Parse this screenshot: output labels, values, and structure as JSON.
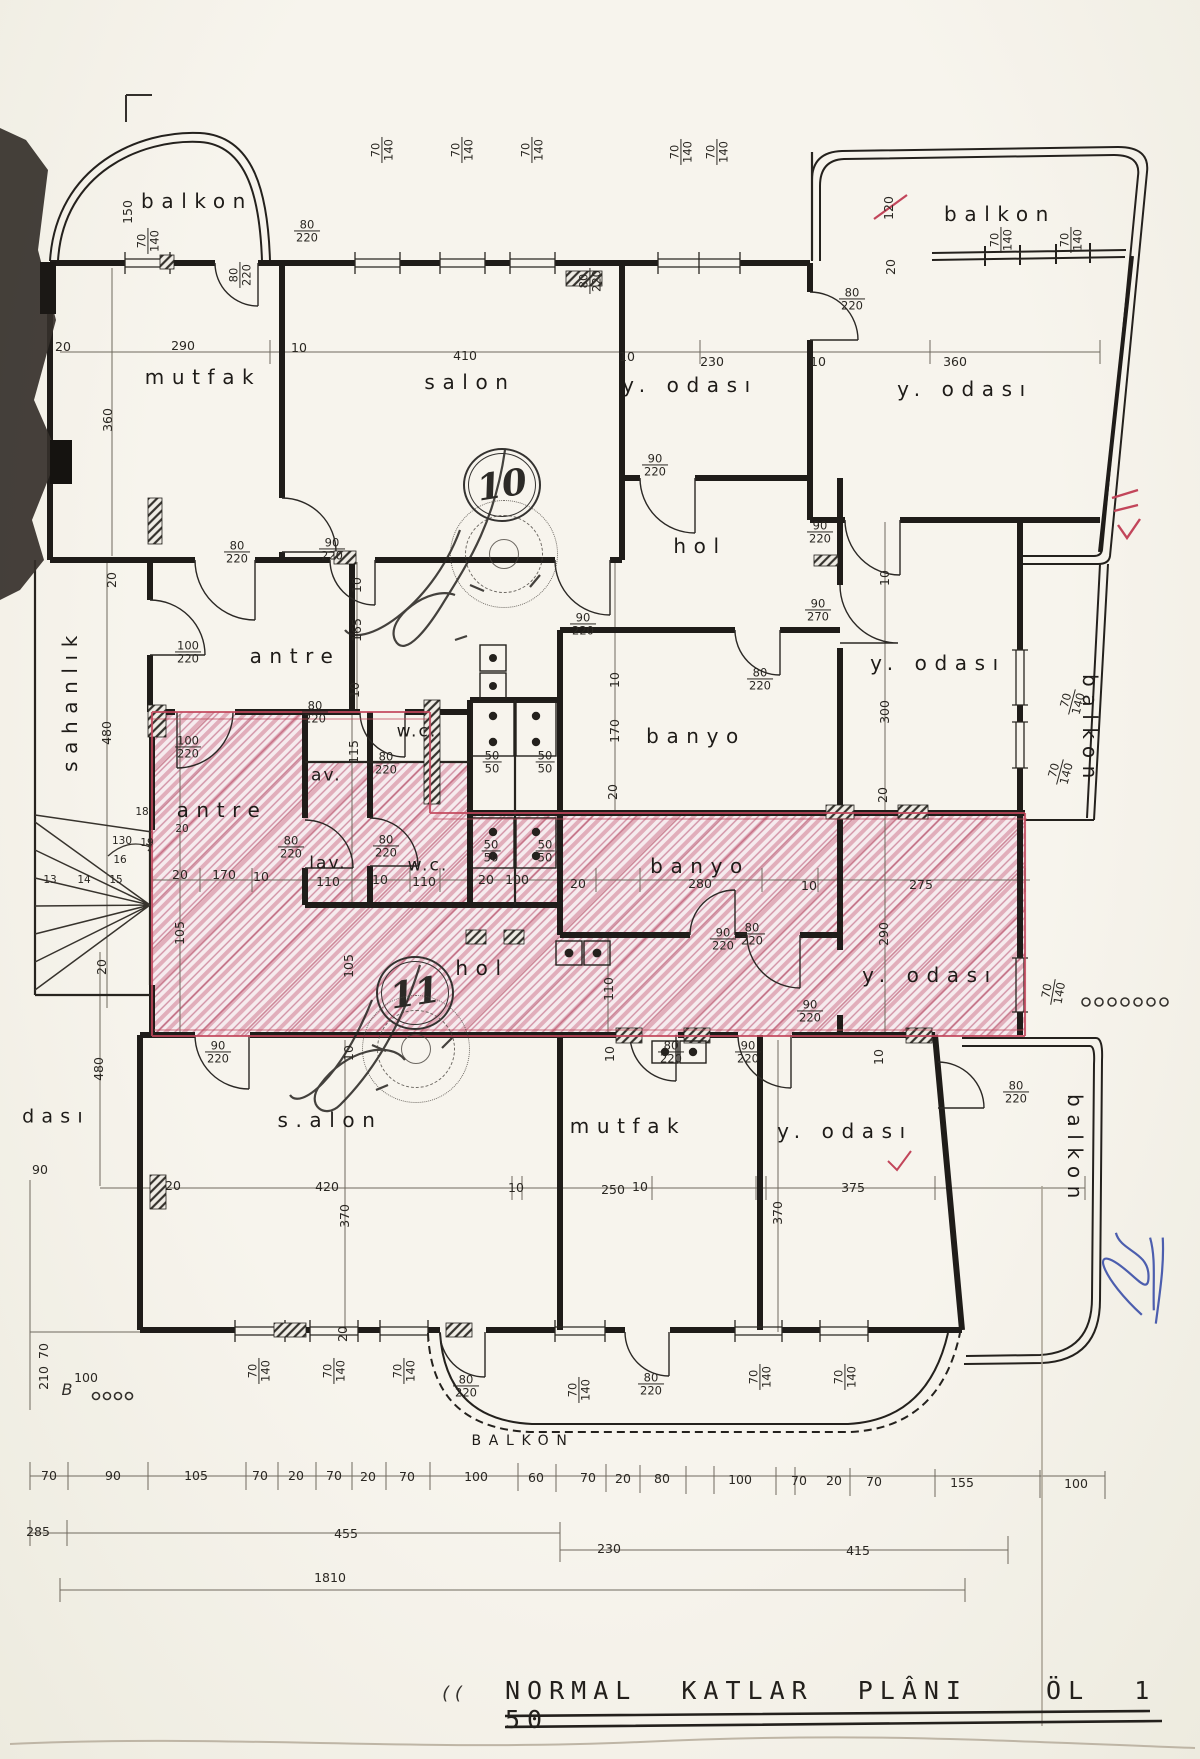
{
  "title_block": {
    "title": "NORMAL KATLAR PLÂNI",
    "scale_note": "ÖL 1 50"
  },
  "stamps": {
    "upper_number": "10",
    "lower_number": "11"
  },
  "plan_labels": {
    "rooms": [
      {
        "t": "balkon",
        "x": 197,
        "y": 201
      },
      {
        "t": "mutfak",
        "x": 203,
        "y": 377
      },
      {
        "t": "salon",
        "x": 470,
        "y": 382
      },
      {
        "t": "y. odası",
        "x": 690,
        "y": 385
      },
      {
        "t": "balkon",
        "x": 1000,
        "y": 214
      },
      {
        "t": "y. odası",
        "x": 965,
        "y": 389
      },
      {
        "t": "hol",
        "x": 700,
        "y": 546
      },
      {
        "t": "antre",
        "x": 295,
        "y": 656
      },
      {
        "t": "w.c.",
        "x": 417,
        "y": 732,
        "fs": 17,
        "ls": ".12em"
      },
      {
        "t": "lav.",
        "x": 323,
        "y": 776,
        "fs": 17,
        "ls": ".12em"
      },
      {
        "t": "banyo",
        "x": 696,
        "y": 736
      },
      {
        "t": "y. odası",
        "x": 938,
        "y": 663
      },
      {
        "t": "balkon",
        "x": 1090,
        "y": 730,
        "r": 90
      },
      {
        "t": "sahanlık",
        "x": 70,
        "y": 700,
        "r": -90
      },
      {
        "t": "antre",
        "x": 222,
        "y": 810
      },
      {
        "t": "lav.",
        "x": 328,
        "y": 864,
        "fs": 17,
        "ls": ".12em"
      },
      {
        "t": "w.c.",
        "x": 428,
        "y": 866,
        "fs": 17,
        "ls": ".12em"
      },
      {
        "t": "banyo",
        "x": 700,
        "y": 866
      },
      {
        "t": "hol",
        "x": 482,
        "y": 968
      },
      {
        "t": "y. odası",
        "x": 930,
        "y": 975
      },
      {
        "t": "s.alon",
        "x": 330,
        "y": 1120
      },
      {
        "t": "mutfak",
        "x": 628,
        "y": 1126
      },
      {
        "t": "y. odası",
        "x": 845,
        "y": 1131
      },
      {
        "t": "balkon",
        "x": 1075,
        "y": 1150,
        "r": 90
      },
      {
        "t": "dası",
        "x": 56,
        "y": 1117,
        "fs": 19
      },
      {
        "t": "BALKON",
        "x": 523,
        "y": 1441,
        "fs": 14,
        "ls": ".55em"
      }
    ],
    "dims": [
      {
        "t": "150",
        "x": 128,
        "y": 212,
        "r": -90
      },
      {
        "t": "70/140",
        "x": 148,
        "y": 241,
        "r": -90
      },
      {
        "t": "80/220",
        "x": 307,
        "y": 231
      },
      {
        "t": "80/220",
        "x": 240,
        "y": 275,
        "r": -90
      },
      {
        "t": "290",
        "x": 183,
        "y": 346
      },
      {
        "t": "20",
        "x": 63,
        "y": 347
      },
      {
        "t": "10",
        "x": 299,
        "y": 348
      },
      {
        "t": "360",
        "x": 108,
        "y": 420,
        "r": -90
      },
      {
        "t": "70/140",
        "x": 382,
        "y": 150,
        "r": -90
      },
      {
        "t": "70/140",
        "x": 462,
        "y": 150,
        "r": -90
      },
      {
        "t": "70/140",
        "x": 532,
        "y": 150,
        "r": -90
      },
      {
        "t": "70/140",
        "x": 681,
        "y": 152,
        "r": -90
      },
      {
        "t": "70/140",
        "x": 717,
        "y": 152,
        "r": -90
      },
      {
        "t": "80/220",
        "x": 590,
        "y": 281,
        "r": -90
      },
      {
        "t": "410",
        "x": 465,
        "y": 356
      },
      {
        "t": "10",
        "x": 627,
        "y": 357
      },
      {
        "t": "230",
        "x": 712,
        "y": 362
      },
      {
        "t": "120",
        "x": 889,
        "y": 208,
        "r": -90
      },
      {
        "t": "20",
        "x": 891,
        "y": 267,
        "r": -90
      },
      {
        "t": "80/220",
        "x": 852,
        "y": 299
      },
      {
        "t": "70/140",
        "x": 1001,
        "y": 240,
        "r": -90
      },
      {
        "t": "70/140",
        "x": 1071,
        "y": 240,
        "r": -90
      },
      {
        "t": "360",
        "x": 955,
        "y": 362
      },
      {
        "t": "10",
        "x": 818,
        "y": 362
      },
      {
        "t": "90/220",
        "x": 655,
        "y": 465
      },
      {
        "t": "90/220",
        "x": 820,
        "y": 532
      },
      {
        "t": "90/220",
        "x": 583,
        "y": 624
      },
      {
        "t": "90/270",
        "x": 818,
        "y": 610
      },
      {
        "t": "80/220",
        "x": 760,
        "y": 679
      },
      {
        "t": "170",
        "x": 615,
        "y": 731,
        "r": -90
      },
      {
        "t": "10",
        "x": 615,
        "y": 680,
        "r": -90
      },
      {
        "t": "20",
        "x": 613,
        "y": 792,
        "r": -90
      },
      {
        "t": "50/50",
        "x": 492,
        "y": 762
      },
      {
        "t": "50/50",
        "x": 545,
        "y": 762
      },
      {
        "t": "100/220",
        "x": 188,
        "y": 652
      },
      {
        "t": "80/220",
        "x": 237,
        "y": 552
      },
      {
        "t": "90/220",
        "x": 332,
        "y": 549
      },
      {
        "t": "165",
        "x": 357,
        "y": 630,
        "r": -90
      },
      {
        "t": "10",
        "x": 357,
        "y": 585,
        "r": -90
      },
      {
        "t": "10",
        "x": 355,
        "y": 690,
        "r": -90
      },
      {
        "t": "115",
        "x": 354,
        "y": 752,
        "r": -90
      },
      {
        "t": "80/220",
        "x": 386,
        "y": 763
      },
      {
        "t": "80/220",
        "x": 315,
        "y": 712
      },
      {
        "t": "20",
        "x": 112,
        "y": 580,
        "r": -90
      },
      {
        "t": "480",
        "x": 107,
        "y": 733,
        "r": -90
      },
      {
        "t": "100/220",
        "x": 188,
        "y": 747
      },
      {
        "t": "10",
        "x": 885,
        "y": 578,
        "r": -90
      },
      {
        "t": "300",
        "x": 885,
        "y": 712,
        "r": -90
      },
      {
        "t": "20",
        "x": 883,
        "y": 795,
        "r": -90
      },
      {
        "t": "70/140",
        "x": 1072,
        "y": 702,
        "r": -75
      },
      {
        "t": "70/140",
        "x": 1060,
        "y": 772,
        "r": -75
      },
      {
        "t": "20",
        "x": 180,
        "y": 875
      },
      {
        "t": "170",
        "x": 224,
        "y": 875
      },
      {
        "t": "10",
        "x": 261,
        "y": 877
      },
      {
        "t": "110",
        "x": 328,
        "y": 882
      },
      {
        "t": "10",
        "x": 380,
        "y": 880
      },
      {
        "t": "110",
        "x": 424,
        "y": 882
      },
      {
        "t": "20",
        "x": 486,
        "y": 880
      },
      {
        "t": "100",
        "x": 517,
        "y": 880
      },
      {
        "t": "20",
        "x": 578,
        "y": 884
      },
      {
        "t": "280",
        "x": 700,
        "y": 884
      },
      {
        "t": "10",
        "x": 809,
        "y": 886
      },
      {
        "t": "275",
        "x": 921,
        "y": 885
      },
      {
        "t": "80/220",
        "x": 291,
        "y": 847
      },
      {
        "t": "80/220",
        "x": 386,
        "y": 846
      },
      {
        "t": "50/50",
        "x": 491,
        "y": 851
      },
      {
        "t": "50/50",
        "x": 545,
        "y": 851
      },
      {
        "t": "290",
        "x": 884,
        "y": 934,
        "r": -90
      },
      {
        "t": "80/220",
        "x": 752,
        "y": 934
      },
      {
        "t": "90/220",
        "x": 723,
        "y": 939
      },
      {
        "t": "110",
        "x": 609,
        "y": 989,
        "r": -90
      },
      {
        "t": "105",
        "x": 180,
        "y": 933,
        "r": -90
      },
      {
        "t": "105",
        "x": 349,
        "y": 966,
        "r": -90
      },
      {
        "t": "90/220",
        "x": 218,
        "y": 1052
      },
      {
        "t": "80/220",
        "x": 671,
        "y": 1052
      },
      {
        "t": "90/220",
        "x": 748,
        "y": 1052
      },
      {
        "t": "90/220",
        "x": 810,
        "y": 1011
      },
      {
        "t": "20",
        "x": 102,
        "y": 967,
        "r": -90
      },
      {
        "t": "480",
        "x": 99,
        "y": 1069,
        "r": -90
      },
      {
        "t": "90",
        "x": 40,
        "y": 1170
      },
      {
        "t": "10",
        "x": 349,
        "y": 1053,
        "r": -90
      },
      {
        "t": "10",
        "x": 610,
        "y": 1054,
        "r": -90
      },
      {
        "t": "20",
        "x": 173,
        "y": 1186
      },
      {
        "t": "420",
        "x": 327,
        "y": 1187
      },
      {
        "t": "370",
        "x": 345,
        "y": 1216,
        "r": -90
      },
      {
        "t": "10",
        "x": 516,
        "y": 1188
      },
      {
        "t": "250",
        "x": 613,
        "y": 1190
      },
      {
        "t": "10",
        "x": 640,
        "y": 1187
      },
      {
        "t": "375",
        "x": 853,
        "y": 1188
      },
      {
        "t": "370",
        "x": 778,
        "y": 1213,
        "r": -90
      },
      {
        "t": "70/140",
        "x": 1053,
        "y": 992,
        "r": -80
      },
      {
        "t": "10",
        "x": 879,
        "y": 1057,
        "r": -90
      },
      {
        "t": "80/220",
        "x": 1016,
        "y": 1092
      },
      {
        "t": "70/140",
        "x": 259,
        "y": 1371,
        "r": -90
      },
      {
        "t": "70/140",
        "x": 334,
        "y": 1371,
        "r": -90
      },
      {
        "t": "70/140",
        "x": 404,
        "y": 1371,
        "r": -90
      },
      {
        "t": "20",
        "x": 343,
        "y": 1334,
        "r": -90
      },
      {
        "t": "80/220",
        "x": 466,
        "y": 1386
      },
      {
        "t": "70/140",
        "x": 579,
        "y": 1390,
        "r": -90
      },
      {
        "t": "80/220",
        "x": 651,
        "y": 1384
      },
      {
        "t": "70/140",
        "x": 760,
        "y": 1377,
        "r": -90
      },
      {
        "t": "70/140",
        "x": 845,
        "y": 1377,
        "r": -90
      },
      {
        "t": "70",
        "x": 44,
        "y": 1351,
        "r": -90
      },
      {
        "t": "210",
        "x": 44,
        "y": 1378,
        "r": -90
      },
      {
        "t": "100",
        "x": 86,
        "y": 1378
      },
      {
        "t": "70",
        "x": 49,
        "y": 1476
      },
      {
        "t": "90",
        "x": 113,
        "y": 1476
      },
      {
        "t": "105",
        "x": 196,
        "y": 1476
      },
      {
        "t": "70",
        "x": 260,
        "y": 1476
      },
      {
        "t": "20",
        "x": 296,
        "y": 1476
      },
      {
        "t": "70",
        "x": 334,
        "y": 1476
      },
      {
        "t": "20",
        "x": 368,
        "y": 1477
      },
      {
        "t": "70",
        "x": 407,
        "y": 1477
      },
      {
        "t": "100",
        "x": 476,
        "y": 1477
      },
      {
        "t": "60",
        "x": 536,
        "y": 1478
      },
      {
        "t": "70",
        "x": 588,
        "y": 1478
      },
      {
        "t": "20",
        "x": 623,
        "y": 1479
      },
      {
        "t": "80",
        "x": 662,
        "y": 1479
      },
      {
        "t": "100",
        "x": 740,
        "y": 1480
      },
      {
        "t": "70",
        "x": 799,
        "y": 1481
      },
      {
        "t": "20",
        "x": 834,
        "y": 1481
      },
      {
        "t": "70",
        "x": 874,
        "y": 1482
      },
      {
        "t": "155",
        "x": 962,
        "y": 1483
      },
      {
        "t": "100",
        "x": 1076,
        "y": 1484
      },
      {
        "t": "285",
        "x": 38,
        "y": 1532
      },
      {
        "t": "455",
        "x": 346,
        "y": 1534
      },
      {
        "t": "230",
        "x": 609,
        "y": 1549
      },
      {
        "t": "415",
        "x": 858,
        "y": 1551
      },
      {
        "t": "1810",
        "x": 330,
        "y": 1578
      }
    ],
    "stairs": [
      {
        "t": "18",
        "x": 142,
        "y": 812
      },
      {
        "t": "130",
        "x": 122,
        "y": 841
      },
      {
        "t": "19",
        "x": 147,
        "y": 843
      },
      {
        "t": "20",
        "x": 182,
        "y": 829
      },
      {
        "t": "16",
        "x": 120,
        "y": 860
      },
      {
        "t": "15",
        "x": 116,
        "y": 880
      },
      {
        "t": "14",
        "x": 84,
        "y": 880
      },
      {
        "t": "13",
        "x": 50,
        "y": 880
      }
    ],
    "marks": [
      {
        "t": "B",
        "x": 67,
        "y": 1390,
        "fs": 16
      },
      {
        "t": "( (",
        "x": 452,
        "y": 1694,
        "fs": 18
      }
    ]
  }
}
